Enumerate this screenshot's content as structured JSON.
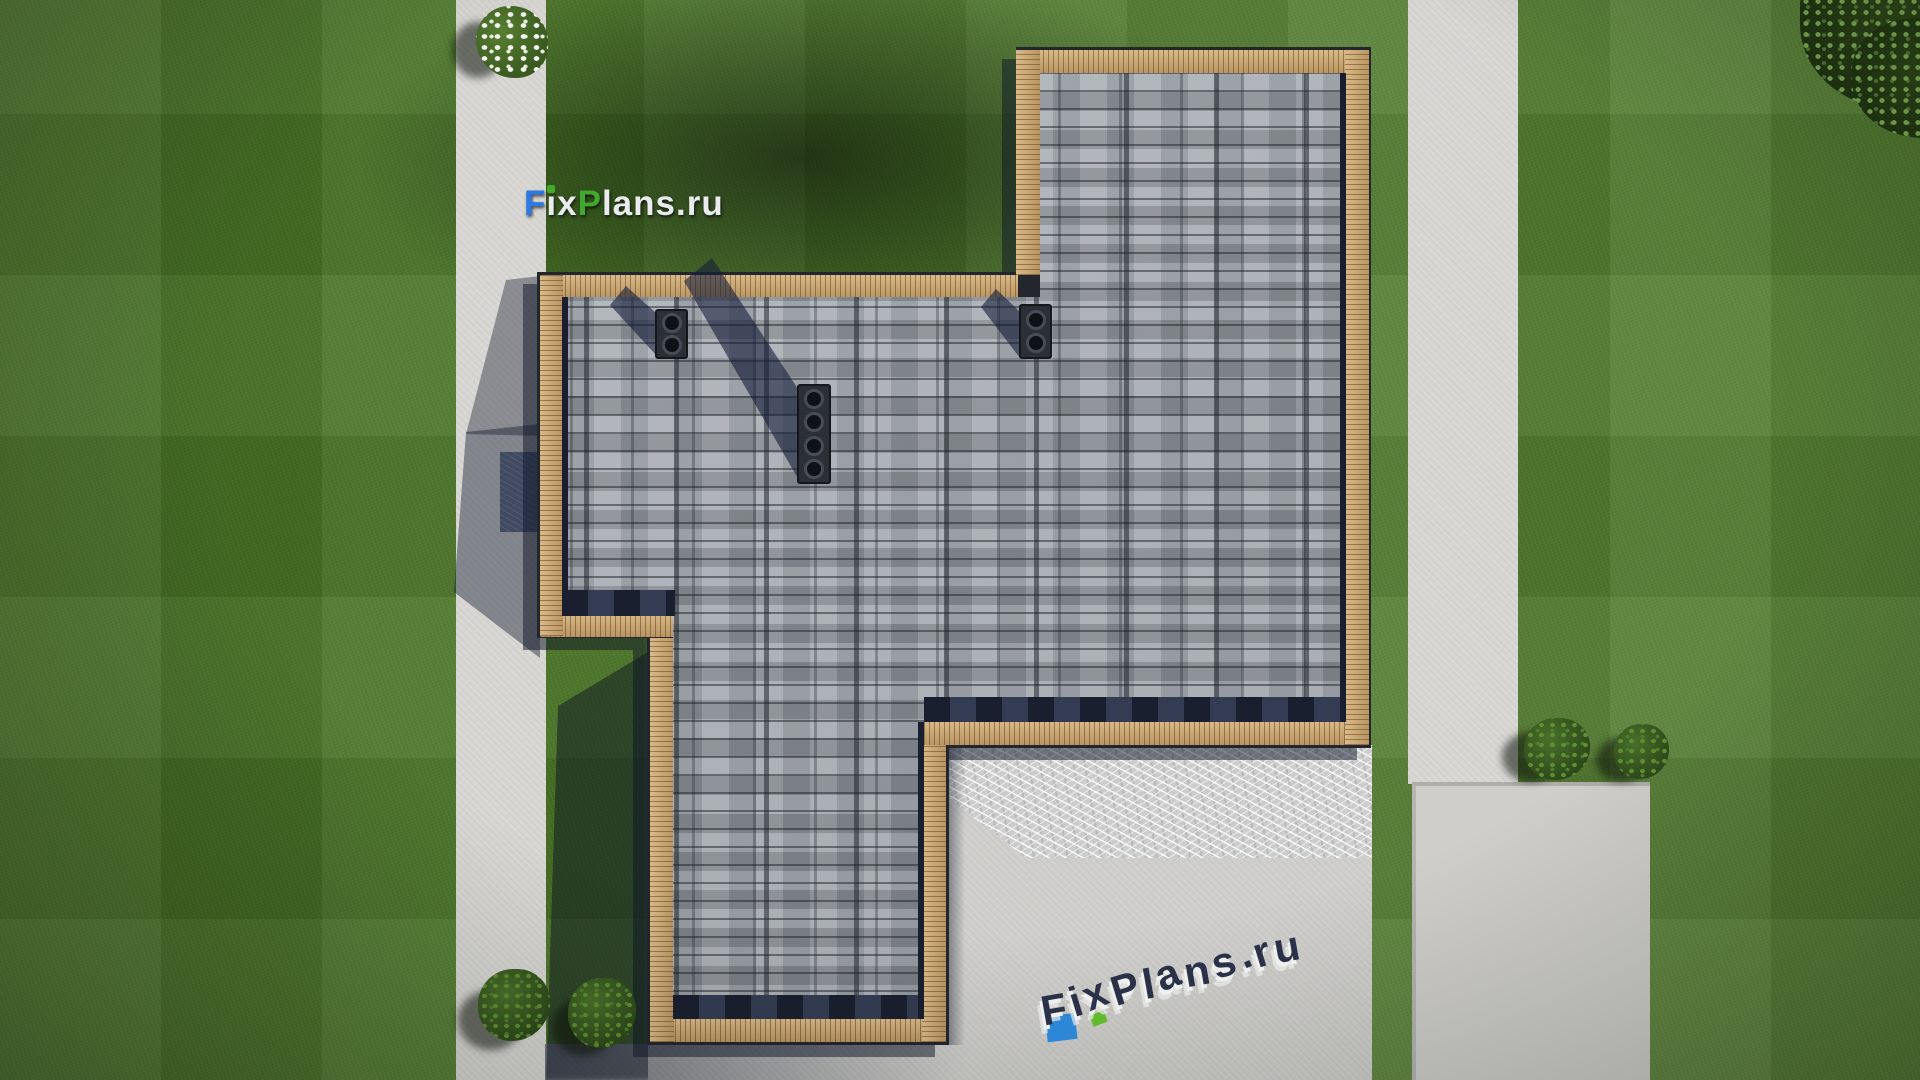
{
  "scene": {
    "view": "top-down 3D render of a house roof plan on a lawn",
    "roof": {
      "material": "gray asphalt shingles",
      "trim": "wood batten edging",
      "chimneys": [
        {
          "vents": 2
        },
        {
          "vents": 2
        },
        {
          "vents": 4
        }
      ]
    },
    "ground": {
      "paths": [
        "left vertical walkway",
        "right vertical walkway",
        "right concrete pad"
      ],
      "terrace": "concrete patio bottom-right",
      "glass_canopy": "white-streaked canopy strip below roof bottom edge"
    },
    "vegetation": [
      "white flowering shrub top-left",
      "two bushes bottom-left",
      "two bushes right side",
      "tree canopy top-right corner"
    ]
  },
  "watermarks": {
    "logo": {
      "text": "FixPlans.ru",
      "segments": [
        {
          "text": "F",
          "color": "#2b79e6"
        },
        {
          "text": "ix",
          "color": "#e9ebee"
        },
        {
          "text": "P",
          "color": "#43a832"
        },
        {
          "text": "lans.ru",
          "color": "#e9ebee"
        }
      ],
      "i_dot_color": "#43aa28"
    },
    "terrace": {
      "text": "FixPlans.ru",
      "top_color": "#2a3148",
      "extrude_color": "#eef0ee",
      "accent_blue": "#2e86d6",
      "accent_green": "#62bb2e"
    }
  },
  "palette": {
    "grass_base": "#4c7827",
    "grass_shadow": "#22341a",
    "path_concrete": "#d8d7d4",
    "terrace_concrete": "#d0cfcc",
    "entrance_pad": "#66718a",
    "glass_streaks": "#e8e9e7",
    "wood_trim": "#d2aa6f",
    "shingle_base": "#99a0a8",
    "eave_shadow_navy": "#273048",
    "roof_outline": "#23262c",
    "chimney_body": "#2b2f36",
    "bush_green": "#3c601f",
    "flower_white": "#f1f2ec"
  }
}
